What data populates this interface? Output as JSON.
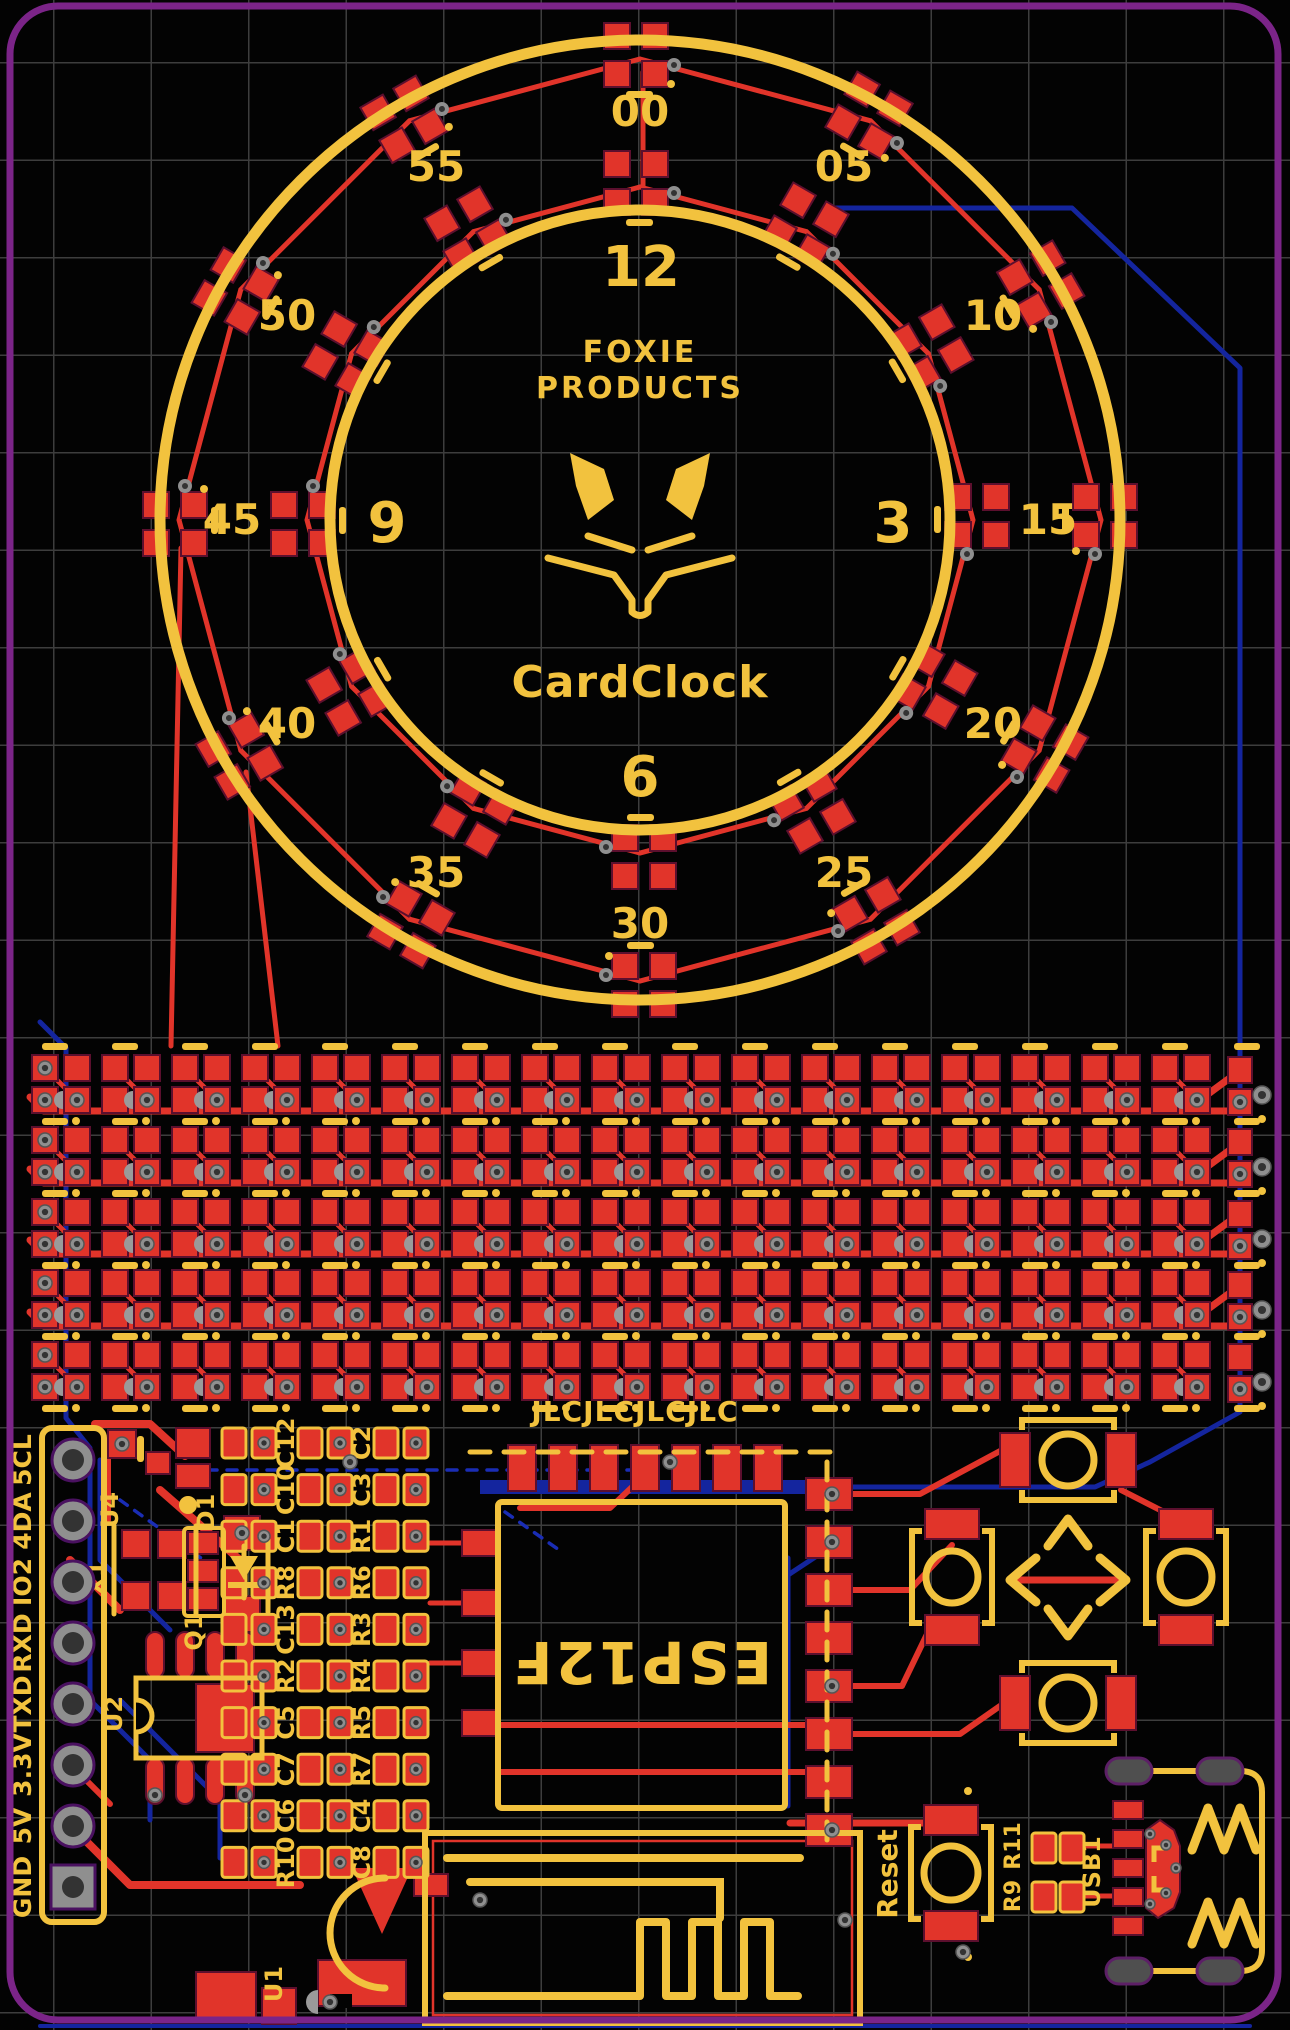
{
  "colors": {
    "background": "#030303",
    "grid": "#3d3d3d",
    "board_outline_purple": "#7b2488",
    "silkscreen_yellow": "#f2c23e",
    "copper_top_red": "#e1342a",
    "copper_bottom_blue": "#14259e",
    "via_gray": "#8f8f8f",
    "hole_dark": "#333333"
  },
  "clock": {
    "brand_line1": "FOXIE",
    "brand_line2": "PRODUCTS",
    "product_name": "CardClock",
    "hour_labels": [
      "12",
      "3",
      "6",
      "9"
    ],
    "minute_labels": [
      "00",
      "05",
      "10",
      "15",
      "20",
      "25",
      "30",
      "35",
      "40",
      "45",
      "50",
      "55"
    ]
  },
  "led_matrix": {
    "rows": 5,
    "cols": 17
  },
  "fab_text": "JLCJLCJLCJLC",
  "module": {
    "label": "ESP12F"
  },
  "header": {
    "pins": [
      "GND",
      "5V",
      "3.3V",
      "TXD",
      "RXD",
      "IO2",
      "4DA",
      "5CL"
    ]
  },
  "refs": {
    "u4": "U4",
    "x1": "X1",
    "q1": "Q1",
    "d1": "D1",
    "u2": "U2",
    "u1": "U1",
    "reset": "Reset",
    "usb": "USB1",
    "r11": "R11",
    "r9": "R9"
  },
  "passives": {
    "col1": [
      "C12",
      "C10",
      "C1",
      "R8",
      "C13",
      "R2",
      "C5",
      "C7",
      "C6",
      "R10"
    ],
    "col2": [
      "C2",
      "C3",
      "R1",
      "R6",
      "R3",
      "R4",
      "R5",
      "R7",
      "C4",
      "C8"
    ]
  }
}
